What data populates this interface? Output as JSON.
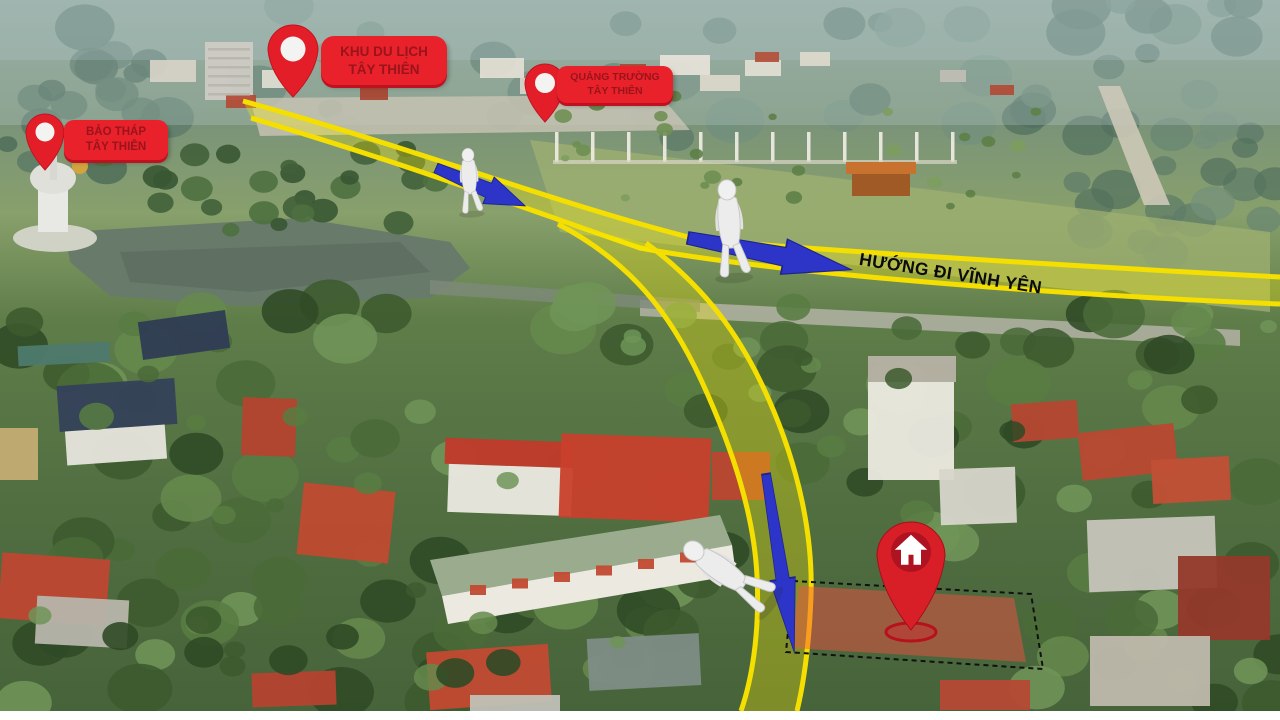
{
  "pins": [
    {
      "id": "bao-thap-tay-thien",
      "line1": "BẢO THÁP",
      "line2": "TÂY THIÊN"
    },
    {
      "id": "khu-du-lich-tay-thien",
      "line1": "KHU DU LỊCH",
      "line2": "TÂY THIÊN"
    },
    {
      "id": "quang-truong-tay-thien",
      "line1": "QUẢNG TRƯỜNG",
      "line2": "TÂY THIÊN"
    }
  ],
  "route": {
    "direction_label": "HƯỚNG ĐI VĨNH YÊN"
  },
  "property_marker": {
    "icon": "house-pin-icon"
  },
  "colors": {
    "pin": "#e41e28",
    "pin_bubble_bg": "#e8212b",
    "pin_bubble_text": "#9a141b",
    "road_outline": "#f4df00",
    "road_fill": "rgba(255,238,0,0.30)",
    "arrow": "#2c35c7",
    "plot_fill": "rgba(255,77,66,0.45)",
    "house_pin": "#d81f28",
    "direction_text": "#0b0b0b"
  }
}
